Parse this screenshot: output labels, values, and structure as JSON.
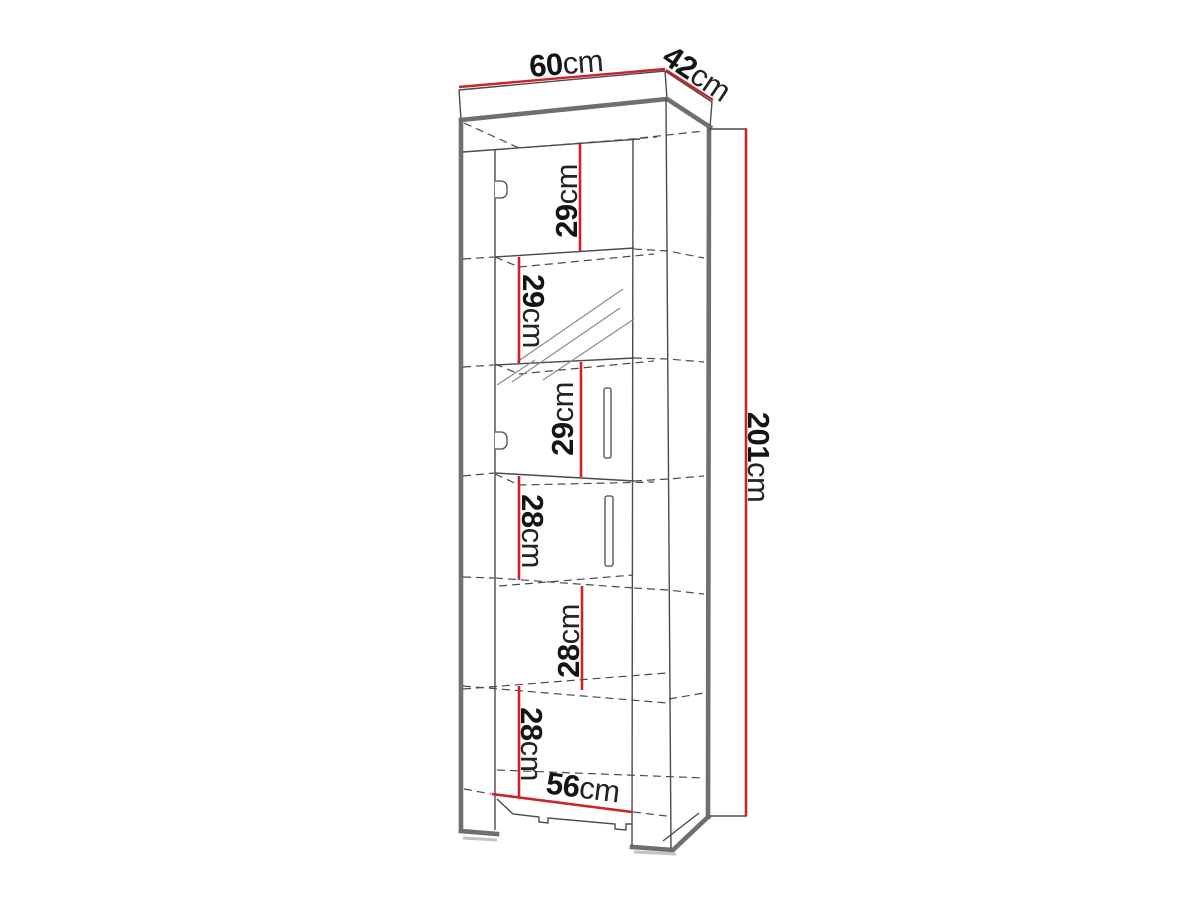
{
  "drawing": {
    "subject": "tall cabinet technical dimension drawing",
    "dimensions": {
      "width": {
        "value": "60",
        "unit": "cm"
      },
      "depth": {
        "value": "42",
        "unit": "cm"
      },
      "height": {
        "value": "201",
        "unit": "cm"
      },
      "inner_width": {
        "value": "56",
        "unit": "cm"
      },
      "compartments": [
        {
          "value": "29",
          "unit": "cm"
        },
        {
          "value": "29",
          "unit": "cm"
        },
        {
          "value": "29",
          "unit": "cm"
        },
        {
          "value": "28",
          "unit": "cm"
        },
        {
          "value": "28",
          "unit": "cm"
        },
        {
          "value": "28",
          "unit": "cm"
        }
      ]
    },
    "colors": {
      "dimension_red": "#cc2229",
      "outline_thick": "#6f6f6f",
      "outline_thin": "#4b4b4b",
      "hatch_gray": "#8c8c8c",
      "shadow_gray": "#c2c2c2",
      "text_dark": "#141414",
      "background": "#ffffff"
    }
  }
}
